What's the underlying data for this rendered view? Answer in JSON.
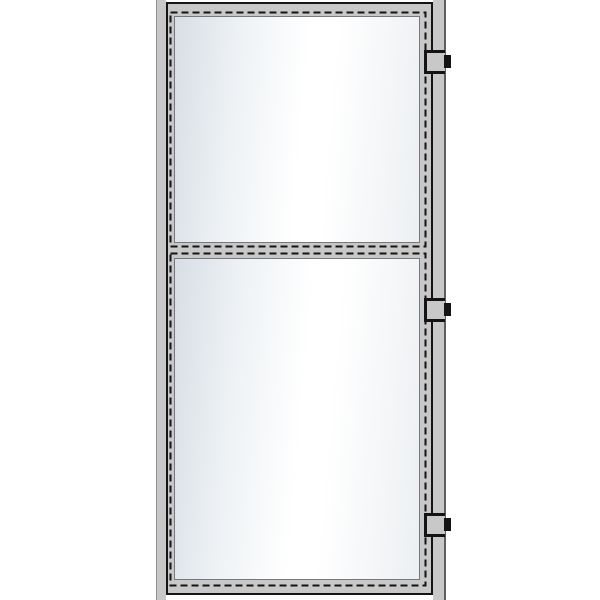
{
  "figure": {
    "type": "technical-drawing",
    "subject": "door-elevation",
    "description": "Front elevation of a hinged door: outer frame jambs, door leaf with two glass panels separated by a mid-rail, dashed seal lines around each panel, three hinges on the right edge",
    "glass_panel_count": 2,
    "hinge_count": 3
  },
  "door": {
    "hinges": [
      {
        "id": "top"
      },
      {
        "id": "middle"
      },
      {
        "id": "bottom"
      }
    ],
    "panels": [
      {
        "id": "top"
      },
      {
        "id": "bottom"
      }
    ]
  },
  "colors": {
    "background": "#ffffff",
    "frame_gray": "#c8c8c8",
    "line_black": "#141414",
    "edge_light": "#8f8f8f",
    "edge_dark": "#5f5f5f",
    "glass_edge": "#d8dee5",
    "glass_light": "#ffffff",
    "glass_far": "#eceff2",
    "glass_border": "#75797d"
  }
}
